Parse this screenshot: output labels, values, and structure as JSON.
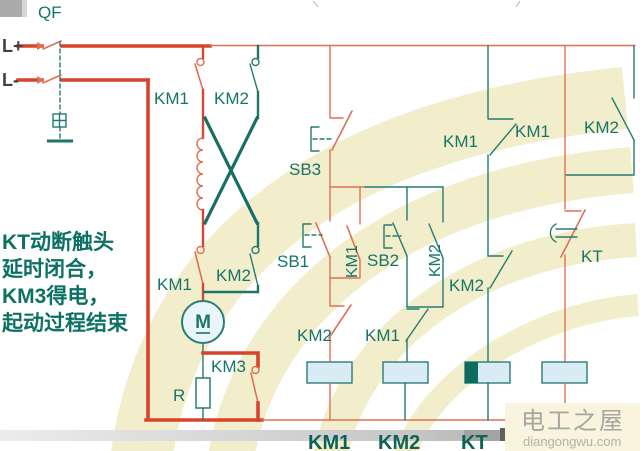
{
  "diagram_title": "DC motor reversing starter control circuit (slide)",
  "power": {
    "breaker": "QF",
    "rail_positive": "L+",
    "rail_negative": "L-"
  },
  "labels": {
    "km1": "KM1",
    "km2": "KM2",
    "km3": "KM3",
    "kt": "KT",
    "r": "R",
    "m": "M",
    "sb1": "SB1",
    "sb2": "SB2",
    "sb3": "SB3"
  },
  "note": {
    "line1": "KT动断触头",
    "line2": "延时闭合，",
    "line3": "KM3得电，",
    "line4": "起动过程结束"
  },
  "bottom_bar": {
    "coil1": "KM1",
    "coil2": "KM2",
    "coil3": "KT"
  },
  "watermark": {
    "site_name": "电工之屋",
    "site_domain": "diangongwu.com"
  },
  "colors": {
    "power_red": "#d8432b",
    "control_salmon": "#dd7056",
    "teal_wire": "#257b70",
    "label_teal": "#16756a",
    "note_teal": "#0c7164",
    "coil_fill": "#d9ecf6",
    "coil_delay_fill": "#0d6b60",
    "swirl_cream": "#f2eecb",
    "watermark_bg": "#f8f4de",
    "bar_gray": "#c9c9c9"
  }
}
